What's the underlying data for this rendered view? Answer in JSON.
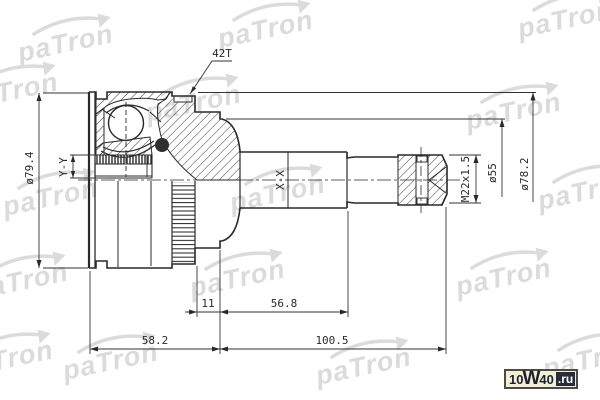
{
  "watermark": {
    "text": "paTron"
  },
  "labels": {
    "teeth_count": "42T",
    "section_inner": "Y-Y",
    "section_shaft": "X-X",
    "dia_outer_left": "ø79.4",
    "dia_bell": "ø78.2",
    "dia_neck": "ø55",
    "thread": "M22x1.5"
  },
  "dimensions": {
    "ring_to_face": "11",
    "shaft_section": "56.8",
    "bell_length": "58.2",
    "total_length": "100.5"
  },
  "logo": {
    "part1": "10",
    "part2": "W",
    "part3": "40",
    "tld": ".ru"
  },
  "colors": {
    "line": "#2a2a2a",
    "watermark": "#dbdbdb",
    "logo_bg": "#f2efd5",
    "logo_text": "#1c2130",
    "logo_badge_bg": "#272c38",
    "logo_badge_text": "#ffffff",
    "background": "#ffffff"
  }
}
